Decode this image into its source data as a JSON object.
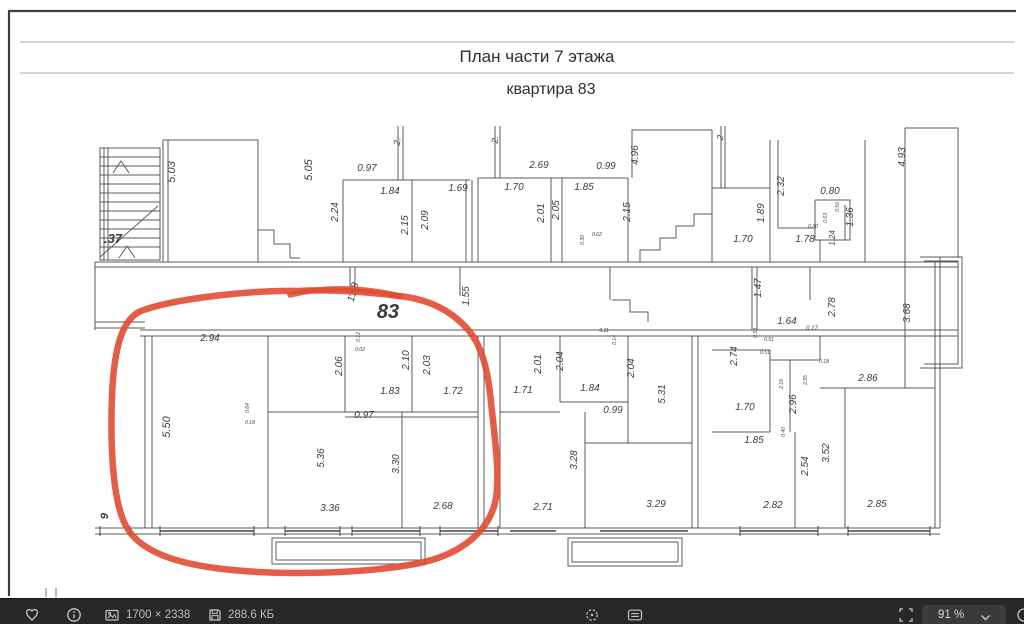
{
  "image": {
    "title_line1": "План части 7 этажа",
    "title_line2": "квартира 83",
    "labels": [
      {
        "t": ".37",
        "x": 113,
        "y": 243,
        "r": 0,
        "s": 13,
        "b": 1
      },
      {
        "t": "5.03",
        "x": 175,
        "y": 172,
        "r": -90,
        "s": 11
      },
      {
        "t": "5.05",
        "x": 312,
        "y": 170,
        "r": -90,
        "s": 11
      },
      {
        "t": "2.",
        "x": 400,
        "y": 142,
        "r": -80,
        "s": 9
      },
      {
        "t": "2.",
        "x": 498,
        "y": 140,
        "r": -80,
        "s": 9
      },
      {
        "t": "2",
        "x": 723,
        "y": 138,
        "r": -80,
        "s": 9
      },
      {
        "t": "0.97",
        "x": 367,
        "y": 171,
        "r": 0,
        "s": 10
      },
      {
        "t": "1.84",
        "x": 390,
        "y": 194,
        "r": 0,
        "s": 10
      },
      {
        "t": "2.24",
        "x": 338,
        "y": 212,
        "r": -90,
        "s": 10
      },
      {
        "t": "2.15",
        "x": 408,
        "y": 225,
        "r": -90,
        "s": 10
      },
      {
        "t": "2.09",
        "x": 428,
        "y": 220,
        "r": -90,
        "s": 10
      },
      {
        "t": "1.69",
        "x": 458,
        "y": 191,
        "r": 0,
        "s": 10
      },
      {
        "t": "2.69",
        "x": 539,
        "y": 168,
        "r": 0,
        "s": 10
      },
      {
        "t": "1.70",
        "x": 514,
        "y": 190,
        "r": 0,
        "s": 10
      },
      {
        "t": "2.01",
        "x": 544,
        "y": 213,
        "r": -90,
        "s": 10
      },
      {
        "t": "2.05",
        "x": 559,
        "y": 210,
        "r": -90,
        "s": 10
      },
      {
        "t": "1.85",
        "x": 584,
        "y": 190,
        "r": 0,
        "s": 10
      },
      {
        "t": "0.99",
        "x": 606,
        "y": 169,
        "r": 0,
        "s": 10
      },
      {
        "t": "4.96",
        "x": 638,
        "y": 155,
        "r": -90,
        "s": 10
      },
      {
        "t": "2.15",
        "x": 630,
        "y": 212,
        "r": -90,
        "s": 10
      },
      {
        "t": "0.30",
        "x": 584,
        "y": 240,
        "r": -90,
        "s": 5
      },
      {
        "t": "0.62",
        "x": 597,
        "y": 236,
        "r": 0,
        "s": 5
      },
      {
        "t": "4.93",
        "x": 905,
        "y": 157,
        "r": -90,
        "s": 10
      },
      {
        "t": "2.32",
        "x": 784,
        "y": 186,
        "r": -90,
        "s": 10
      },
      {
        "t": "1.89",
        "x": 764,
        "y": 213,
        "r": -90,
        "s": 10
      },
      {
        "t": "1.70",
        "x": 743,
        "y": 242,
        "r": 0,
        "s": 10
      },
      {
        "t": "1.78",
        "x": 805,
        "y": 242,
        "r": 0,
        "s": 10
      },
      {
        "t": "0.80",
        "x": 830,
        "y": 194,
        "r": 0,
        "s": 10
      },
      {
        "t": "0.50",
        "x": 839,
        "y": 207,
        "r": -90,
        "s": 5
      },
      {
        "t": "0.53",
        "x": 827,
        "y": 218,
        "r": -90,
        "s": 5
      },
      {
        "t": "0.30",
        "x": 813,
        "y": 228,
        "r": 0,
        "s": 5
      },
      {
        "t": "1.36",
        "x": 853,
        "y": 217,
        "r": -90,
        "s": 10
      },
      {
        "t": "1.24",
        "x": 835,
        "y": 238,
        "r": -90,
        "s": 8
      },
      {
        "t": "1.58",
        "x": 356,
        "y": 293,
        "r": -75,
        "s": 10
      },
      {
        "t": "83",
        "x": 388,
        "y": 318,
        "r": 0,
        "s": 20,
        "b": 1
      },
      {
        "t": "1.55",
        "x": 469,
        "y": 296,
        "r": -90,
        "s": 10
      },
      {
        "t": "1.47",
        "x": 761,
        "y": 288,
        "r": -90,
        "s": 10
      },
      {
        "t": "2.94",
        "x": 210,
        "y": 341,
        "r": 0,
        "s": 10
      },
      {
        "t": "0.12",
        "x": 360,
        "y": 337,
        "r": -90,
        "s": 5
      },
      {
        "t": "0.02",
        "x": 360,
        "y": 351,
        "r": 0,
        "s": 5
      },
      {
        "t": "2.06",
        "x": 342,
        "y": 366,
        "r": -90,
        "s": 10
      },
      {
        "t": "2.10",
        "x": 409,
        "y": 360,
        "r": -90,
        "s": 10
      },
      {
        "t": "2.03",
        "x": 430,
        "y": 365,
        "r": -90,
        "s": 10
      },
      {
        "t": "1.83",
        "x": 390,
        "y": 394,
        "r": 0,
        "s": 10
      },
      {
        "t": "1.72",
        "x": 453,
        "y": 394,
        "r": 0,
        "s": 10
      },
      {
        "t": "0.97",
        "x": 364,
        "y": 418,
        "r": 0,
        "s": 10
      },
      {
        "t": "5.50",
        "x": 170,
        "y": 427,
        "r": -90,
        "s": 11
      },
      {
        "t": "0.64",
        "x": 249,
        "y": 408,
        "r": -90,
        "s": 5
      },
      {
        "t": "0.18",
        "x": 250,
        "y": 424,
        "r": 0,
        "s": 5
      },
      {
        "t": "5.36",
        "x": 324,
        "y": 458,
        "r": -90,
        "s": 10
      },
      {
        "t": "3.30",
        "x": 399,
        "y": 464,
        "r": -90,
        "s": 10
      },
      {
        "t": "3.36",
        "x": 330,
        "y": 511,
        "r": 0,
        "s": 10
      },
      {
        "t": "2.68",
        "x": 443,
        "y": 509,
        "r": 0,
        "s": 10
      },
      {
        "t": "0.11",
        "x": 604,
        "y": 332,
        "r": 0,
        "s": 5
      },
      {
        "t": "0.14",
        "x": 616,
        "y": 340,
        "r": -90,
        "s": 5
      },
      {
        "t": "2.01",
        "x": 541,
        "y": 364,
        "r": -90,
        "s": 10
      },
      {
        "t": "2.04",
        "x": 563,
        "y": 361,
        "r": -90,
        "s": 10
      },
      {
        "t": "1.71",
        "x": 523,
        "y": 393,
        "r": 0,
        "s": 10
      },
      {
        "t": "1.84",
        "x": 590,
        "y": 391,
        "r": 0,
        "s": 10
      },
      {
        "t": "2.04",
        "x": 634,
        "y": 368,
        "r": -90,
        "s": 10
      },
      {
        "t": "5.31",
        "x": 665,
        "y": 394,
        "r": -90,
        "s": 10
      },
      {
        "t": "0.99",
        "x": 613,
        "y": 413,
        "r": 0,
        "s": 10
      },
      {
        "t": "3.28",
        "x": 577,
        "y": 460,
        "r": -90,
        "s": 10
      },
      {
        "t": "2.71",
        "x": 543,
        "y": 510,
        "r": 0,
        "s": 10
      },
      {
        "t": "3.29",
        "x": 656,
        "y": 507,
        "r": 0,
        "s": 10
      },
      {
        "t": "2.78",
        "x": 835,
        "y": 307,
        "r": -90,
        "s": 10
      },
      {
        "t": "3.68",
        "x": 910,
        "y": 313,
        "r": -90,
        "s": 10
      },
      {
        "t": "1.64",
        "x": 787,
        "y": 324,
        "r": 0,
        "s": 10
      },
      {
        "t": "0.17",
        "x": 812,
        "y": 330,
        "r": 0,
        "s": 6
      },
      {
        "t": "0.58",
        "x": 757,
        "y": 333,
        "r": -90,
        "s": 5
      },
      {
        "t": "0.51",
        "x": 769,
        "y": 341,
        "r": 0,
        "s": 5
      },
      {
        "t": "0.51",
        "x": 765,
        "y": 354,
        "r": 0,
        "s": 5
      },
      {
        "t": "2.74",
        "x": 737,
        "y": 356,
        "r": -90,
        "s": 10
      },
      {
        "t": "0.18",
        "x": 824,
        "y": 363,
        "r": 0,
        "s": 5
      },
      {
        "t": "2.19",
        "x": 783,
        "y": 384,
        "r": -90,
        "s": 5
      },
      {
        "t": "2.95",
        "x": 807,
        "y": 380,
        "r": -90,
        "s": 5
      },
      {
        "t": "2.96",
        "x": 796,
        "y": 404,
        "r": -90,
        "s": 10
      },
      {
        "t": "1.70",
        "x": 745,
        "y": 410,
        "r": 0,
        "s": 10
      },
      {
        "t": "0.40",
        "x": 785,
        "y": 432,
        "r": -90,
        "s": 5
      },
      {
        "t": "2.86",
        "x": 868,
        "y": 381,
        "r": 0,
        "s": 10
      },
      {
        "t": "1.85",
        "x": 754,
        "y": 443,
        "r": 0,
        "s": 10
      },
      {
        "t": "2.54",
        "x": 808,
        "y": 466,
        "r": -90,
        "s": 10
      },
      {
        "t": "3.52",
        "x": 829,
        "y": 453,
        "r": -90,
        "s": 10
      },
      {
        "t": "2.82",
        "x": 773,
        "y": 508,
        "r": 0,
        "s": 10
      },
      {
        "t": "2.85",
        "x": 877,
        "y": 507,
        "r": 0,
        "s": 10
      },
      {
        "t": "9",
        "x": 108,
        "y": 516,
        "r": -90,
        "s": 11,
        "b": 1
      }
    ]
  },
  "colors": {
    "marker": "#e14b33",
    "wall": "#5b5b5b",
    "dim_text": "#3c3c3c",
    "title_text": "#2e2e2e",
    "toolbar_bg": "#282828",
    "toolbar_icon": "#c6c6c6"
  },
  "toolbar": {
    "dimensions_text": "1700 × 2338",
    "size_text": "288.6 КБ",
    "zoom_text": "91 %",
    "icons": {
      "favorite": "heart-outline",
      "info": "circle-i",
      "dimensions": "photo-frame",
      "size": "floppy-disk",
      "rotate": "dashed-circle-dot",
      "notes": "card-lines",
      "fit": "corner-brackets",
      "zoom_menu": "chevron-down",
      "edge_partial": "partial-circle"
    }
  }
}
